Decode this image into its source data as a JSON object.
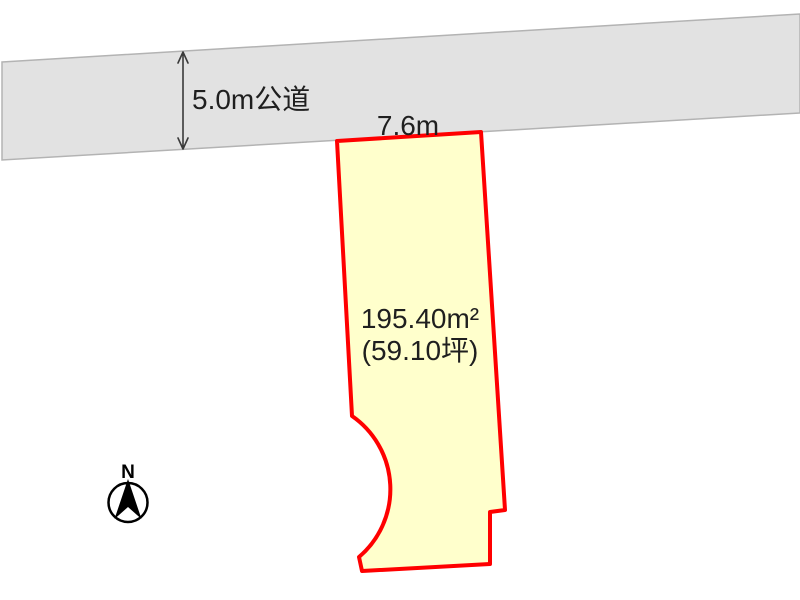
{
  "page": {
    "width": 800,
    "height": 600,
    "background": "#ffffff"
  },
  "diagram": {
    "road": {
      "label": "5.0m公道",
      "fill": "#e2e2e2",
      "border_color": "#b3b3b3"
    },
    "frontage": {
      "label": "7.6m"
    },
    "plot": {
      "area_label": "195.40m²",
      "tsubo_label": "(59.10坪)",
      "fill": "#ffffcc",
      "outline_color": "#ff0000"
    },
    "compass": {
      "north_label": "N"
    }
  }
}
